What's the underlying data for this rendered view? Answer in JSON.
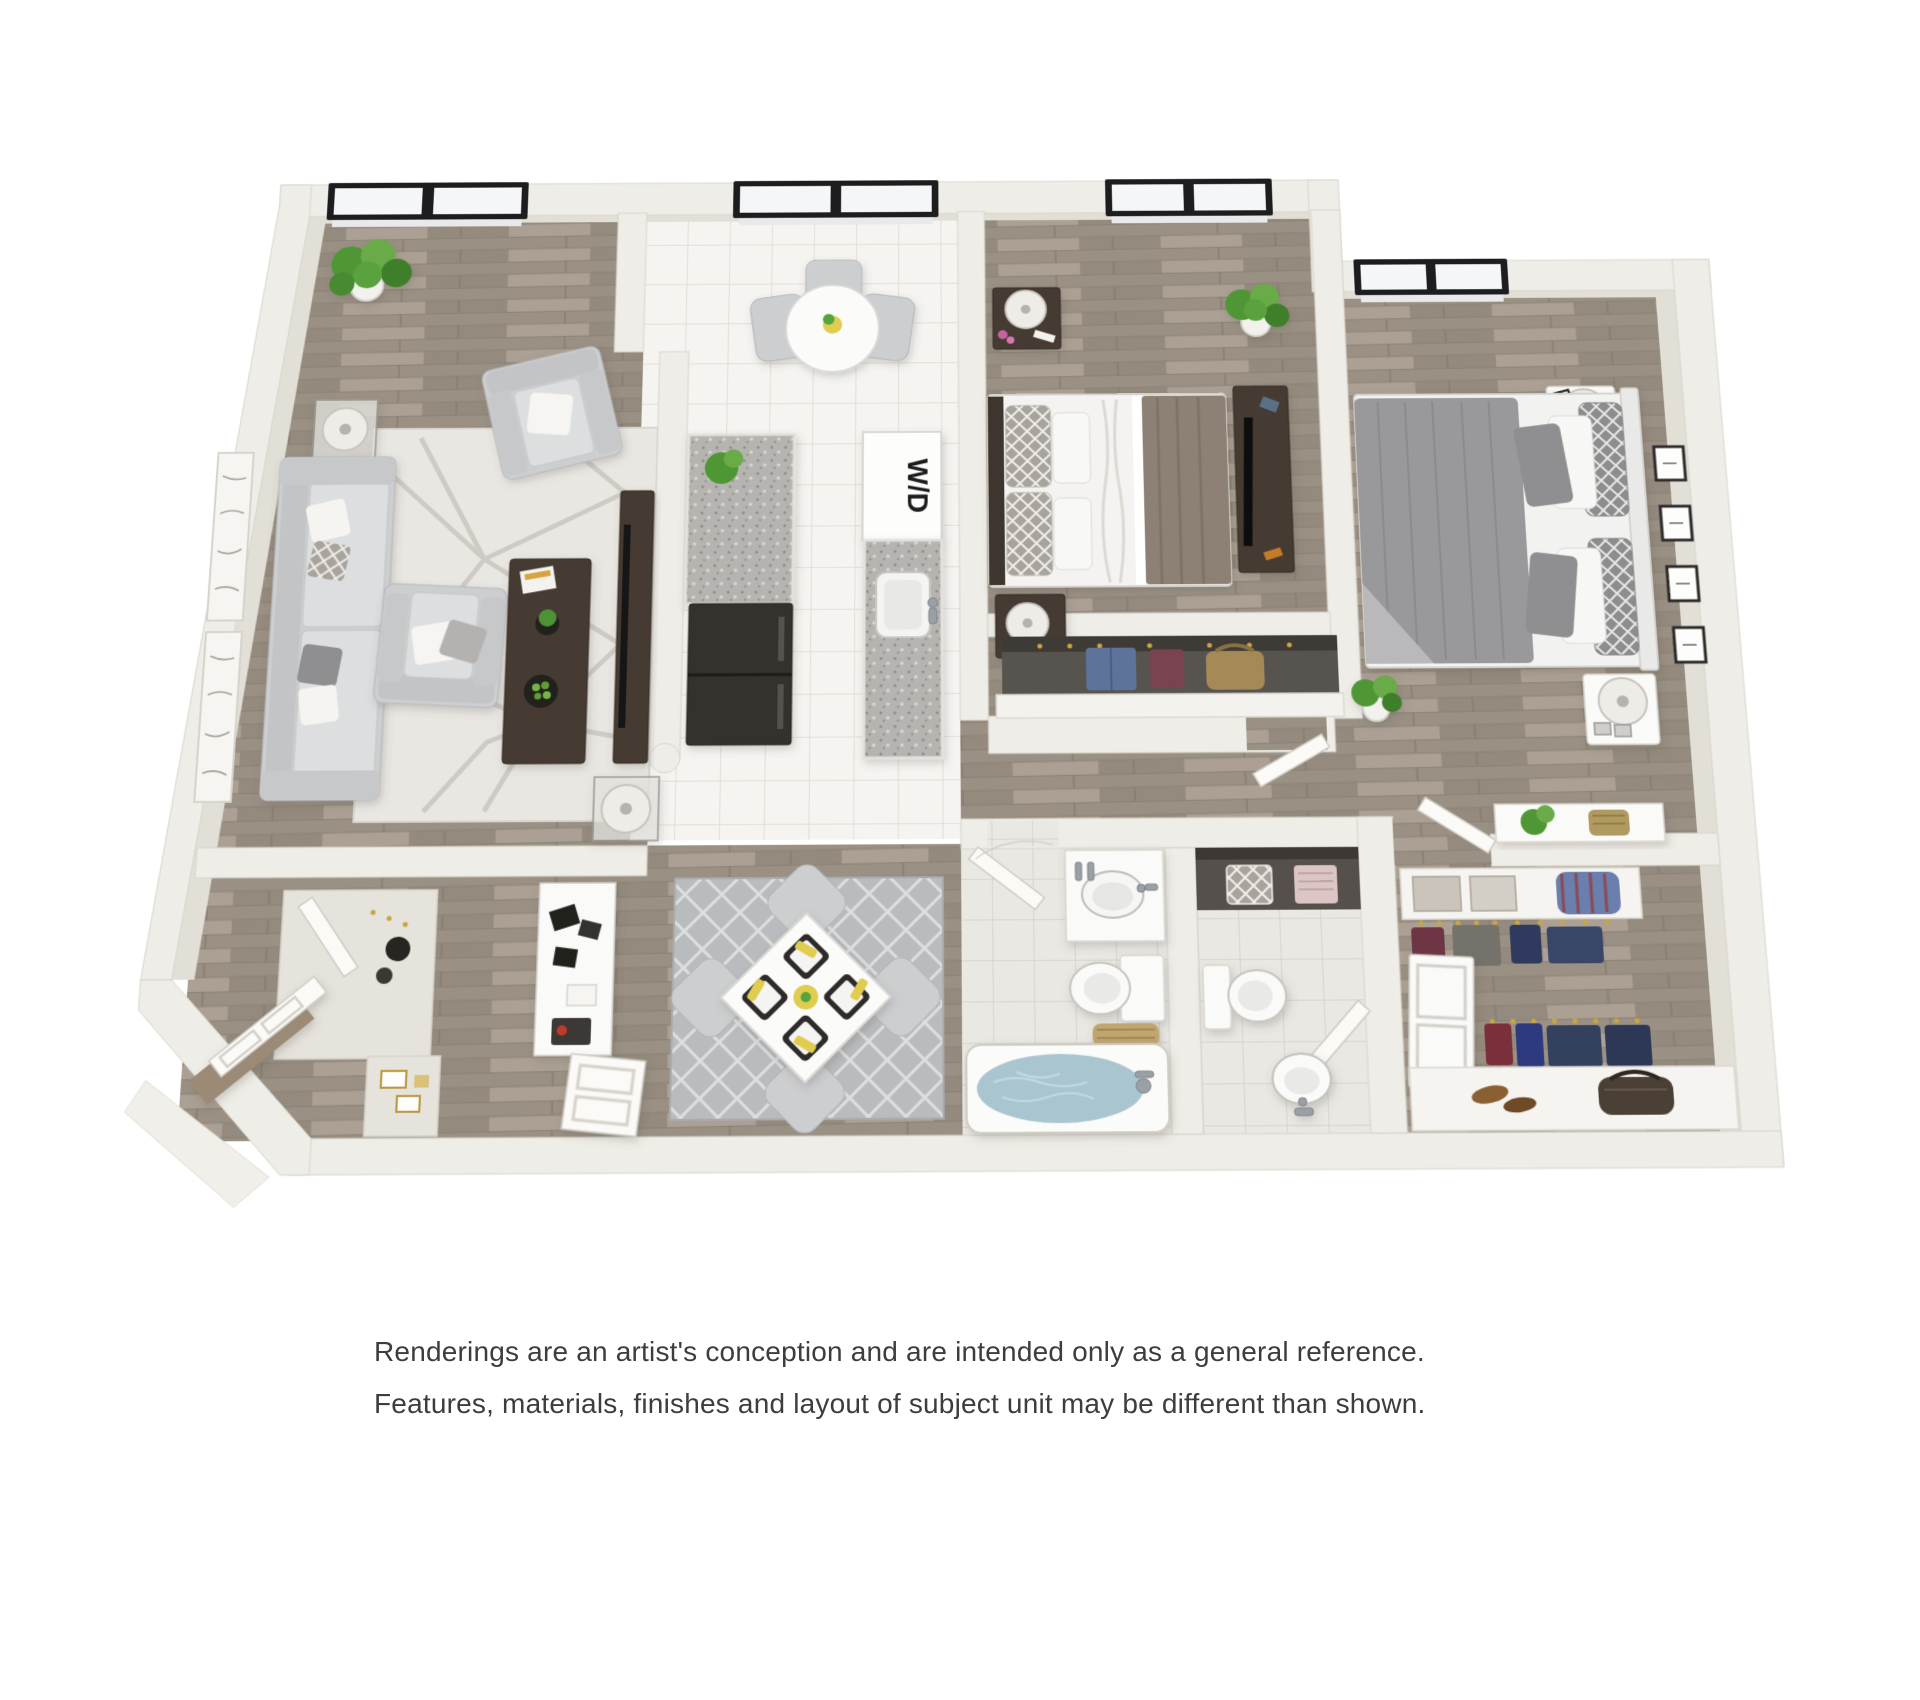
{
  "plan": {
    "type": "3d-rendered-floor-plan",
    "washer_dryer_label": "W/D",
    "rooms": [
      {
        "name": "living-room",
        "features": [
          "window",
          "potted-plant",
          "sofa",
          "armchair-top",
          "armchair-bottom",
          "coffee-table",
          "geometric-rug",
          "tv-console",
          "side-table-lamps",
          "wall-art-panels"
        ]
      },
      {
        "name": "kitchen",
        "features": [
          "window",
          "round-dining-table",
          "gray-chairs",
          "granite-counters",
          "counter-plant",
          "refrigerator",
          "stacked-washer-dryer",
          "sink"
        ]
      },
      {
        "name": "bedroom-1",
        "features": [
          "window",
          "bed-white-and-brown",
          "trellis-pillows",
          "two-dark-nightstands",
          "drum-lamps",
          "tv-dresser",
          "potted-plant",
          "closet-with-clothes"
        ]
      },
      {
        "name": "bedroom-2",
        "features": [
          "window",
          "bed-gray-duvet",
          "trellis-pillows",
          "two-white-nightstands",
          "drum-lamps",
          "four-picture-frames",
          "potted-plant"
        ]
      },
      {
        "name": "bathroom-1",
        "features": [
          "door",
          "vanity-sink",
          "toilet",
          "towel-basket",
          "bathtub-with-water"
        ]
      },
      {
        "name": "bathroom-2",
        "features": [
          "linen-shelf-towels",
          "toilet",
          "door",
          "pedestal-sink"
        ]
      },
      {
        "name": "walk-in-closet",
        "features": [
          "console-with-plant",
          "shelf-boxes",
          "duffel-bag",
          "hanging-clothes",
          "double-door-cabinet",
          "shoe-shelf",
          "handbag"
        ]
      },
      {
        "name": "entry",
        "features": [
          "open-entry-door",
          "wood-threshold",
          "coat-closet",
          "console-with-gadgets",
          "storage-cubby",
          "interior-door"
        ]
      },
      {
        "name": "dining-nook",
        "features": [
          "lattice-rug",
          "square-table-rotated",
          "four-chairs",
          "black-placemats",
          "white-plates",
          "yellow-napkins",
          "centerpiece"
        ]
      }
    ],
    "colors": {
      "background": "#ffffff",
      "wall": "#efede7",
      "wall_inner_face": "#e2dfd7",
      "wood_floor": "#a2988c",
      "kitchen_tile": "#f4f3f0",
      "bath_tile": "#eae8e3",
      "window_frame": "#1d1d1f",
      "living_rug": "#e9e7e2",
      "dining_rug": "#b9bcbe",
      "bath_water": "#a9c5d0",
      "plant_green": "#55a33c",
      "accent_yellow": "#e0cd50",
      "dark_furniture": "#443a32",
      "duvet_gray": "#99989a",
      "blanket_brown": "#8d8174"
    }
  },
  "disclaimer": {
    "line1": "Renderings are an artist's conception and are intended only as a general reference.",
    "line2": "Features, materials, finishes and layout of subject unit may be different than shown."
  }
}
